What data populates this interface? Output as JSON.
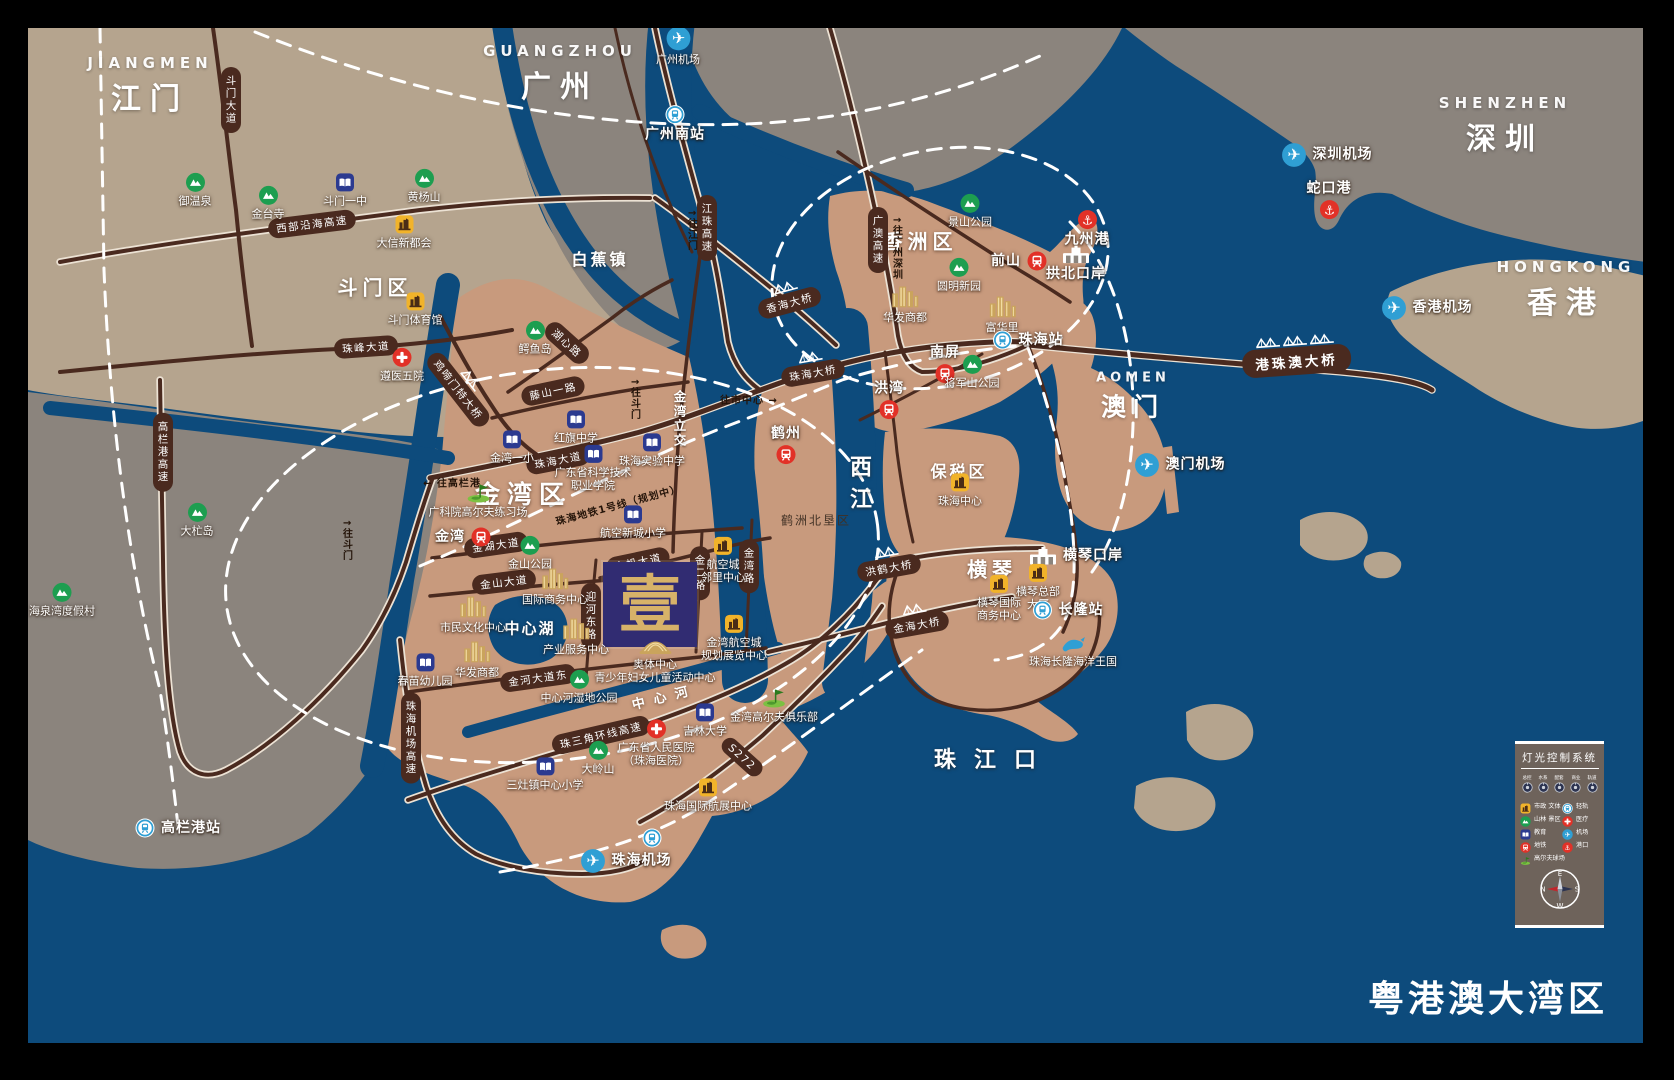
{
  "title": "粤港澳大湾区",
  "colors": {
    "sea": "#0d4b7c",
    "gray": "#8b847d",
    "tan": "#b5a48e",
    "zhuhai": "#c89a7d",
    "road": "#4a2a1f",
    "casing": "#ece2d4",
    "dash": "#ffffff",
    "logo": "#312c72",
    "gold": "#d7b269",
    "legend": "#6e635b",
    "green": "#1d9e50",
    "edu": "#2b3a90",
    "civic": "#f1b32a",
    "red": "#e23127",
    "rail": "#2f9fd4",
    "bld": "#caa45c"
  },
  "logo": {
    "char": "壹"
  },
  "legend": {
    "title": "灯光控制系统",
    "knobs": [
      "总控",
      "水系",
      "配套",
      "商业",
      "轨道"
    ],
    "items": [
      {
        "label": "市政 文体",
        "type": "civic"
      },
      {
        "label": "轻轨",
        "type": "rail"
      },
      {
        "label": "山林 景区",
        "type": "mountain"
      },
      {
        "label": "医疗",
        "type": "hospital"
      },
      {
        "label": "教育",
        "type": "education"
      },
      {
        "label": "机场",
        "type": "airport"
      },
      {
        "label": "地铁",
        "type": "metro"
      },
      {
        "label": "港口",
        "type": "port"
      },
      {
        "label": "高尔夫球场",
        "type": "golf"
      }
    ],
    "compass": {
      "top": "E",
      "left": "N",
      "right": "S",
      "bottom": "W"
    }
  },
  "map": {
    "cities": [
      {
        "en": "JIANGMEN",
        "zh": "江门",
        "x": 150,
        "y": 86
      },
      {
        "en": "GUANGZHOU",
        "zh": "广州",
        "x": 560,
        "y": 74
      },
      {
        "en": "SHENZHEN",
        "zh": "深圳",
        "x": 1505,
        "y": 126
      },
      {
        "en": "HONGKONG",
        "zh": "香港",
        "x": 1566,
        "y": 290
      },
      {
        "en": "AOMEN",
        "zh": "澳门",
        "x": 1133,
        "y": 397,
        "small": true
      }
    ],
    "areas": [
      {
        "l": "斗门区",
        "x": 375,
        "y": 286,
        "fs": 20,
        "ls": 5
      },
      {
        "l": "白蕉镇",
        "x": 600,
        "y": 258,
        "fs": 16,
        "ls": 3
      },
      {
        "l": "香洲区",
        "x": 920,
        "y": 240,
        "fs": 20,
        "ls": 5
      },
      {
        "l": "金湾区",
        "x": 523,
        "y": 493,
        "fs": 25,
        "ls": 7
      },
      {
        "l": "保税区",
        "x": 959,
        "y": 470,
        "fs": 16,
        "ls": 3
      },
      {
        "l": "横琴",
        "x": 992,
        "y": 568,
        "fs": 20,
        "ls": 5
      },
      {
        "l": "鹤洲北垦区",
        "x": 816,
        "y": 520,
        "fs": 12,
        "ls": 2,
        "dark": true
      },
      {
        "l": "中心湖",
        "x": 530,
        "y": 628,
        "fs": 15,
        "ls": 2
      }
    ],
    "water": [
      {
        "l": "西江",
        "x": 858,
        "y": 487,
        "fs": 22,
        "ls": 10,
        "v": true
      },
      {
        "l": "中心河",
        "x": 664,
        "y": 696,
        "fs": 13,
        "ls": 9,
        "rot": -14
      },
      {
        "l": "珠江口",
        "x": 994,
        "y": 758,
        "fs": 22,
        "ls": 18
      }
    ],
    "nav": [
      {
        "l": "往市中心 →",
        "x": 749,
        "y": 399
      },
      {
        "l": "← 往高栏港",
        "x": 452,
        "y": 482
      },
      {
        "l": "↑往斗门",
        "x": 634,
        "y": 399,
        "v": true
      },
      {
        "l": "↑往斗门",
        "x": 346,
        "y": 540,
        "v": true
      },
      {
        "l": "↑往江门",
        "x": 691,
        "y": 230,
        "v": true
      },
      {
        "l": "↑往广州深圳",
        "x": 896,
        "y": 248,
        "v": true
      },
      {
        "l": "金湾立交",
        "x": 679,
        "y": 419,
        "v": true,
        "w": true
      },
      {
        "l": "珠海地铁1号线（规划中）",
        "x": 618,
        "y": 504,
        "rot": -15
      }
    ],
    "road_badges": [
      {
        "l": "斗门大道",
        "x": 231,
        "y": 100,
        "v": true
      },
      {
        "l": "西部沿海高速",
        "x": 312,
        "y": 224,
        "r": -7
      },
      {
        "l": "江珠高速",
        "x": 707,
        "y": 228,
        "v": true
      },
      {
        "l": "广澳高速",
        "x": 878,
        "y": 240,
        "v": true
      },
      {
        "l": "珠峰大道",
        "x": 366,
        "y": 347,
        "r": -4
      },
      {
        "l": "湖心路",
        "x": 567,
        "y": 343,
        "r": 42
      },
      {
        "l": "藤山一路",
        "x": 553,
        "y": 391,
        "r": -12
      },
      {
        "l": "珠海大道",
        "x": 558,
        "y": 460,
        "r": -11
      },
      {
        "l": "金湖大道",
        "x": 496,
        "y": 545,
        "r": -8
      },
      {
        "l": "金山大道",
        "x": 504,
        "y": 582,
        "r": -7
      },
      {
        "l": "金河大道东",
        "x": 538,
        "y": 678,
        "r": -8
      },
      {
        "l": "金帆大道",
        "x": 638,
        "y": 562,
        "r": -12
      },
      {
        "l": "迎河东路",
        "x": 591,
        "y": 616,
        "v": true
      },
      {
        "l": "金二路",
        "x": 700,
        "y": 573,
        "v": true
      },
      {
        "l": "金湾路",
        "x": 749,
        "y": 566,
        "v": true
      },
      {
        "l": "珠三角环线高速",
        "x": 601,
        "y": 735,
        "r": -13
      },
      {
        "l": "S272",
        "x": 742,
        "y": 757,
        "r": 42
      },
      {
        "l": "珠海机场高速",
        "x": 411,
        "y": 738,
        "v": true
      },
      {
        "l": "高栏港高速",
        "x": 163,
        "y": 452,
        "v": true
      }
    ],
    "bridges": [
      {
        "l": "鸡啼门特大桥",
        "x": 463,
        "y": 386,
        "r": 52
      },
      {
        "l": "香海大桥",
        "x": 788,
        "y": 297,
        "r": -15
      },
      {
        "l": "珠海大桥",
        "x": 812,
        "y": 367,
        "r": -10
      },
      {
        "l": "洪鹤大桥",
        "x": 888,
        "y": 562,
        "r": -10
      },
      {
        "l": "金海大桥",
        "x": 916,
        "y": 619,
        "r": -10
      },
      {
        "l": "港珠澳大桥",
        "x": 1296,
        "y": 355,
        "r": -4,
        "big": true,
        "n": 3
      }
    ],
    "markers": [
      {
        "t": "mountain",
        "x": 195,
        "y": 190,
        "l": "御温泉"
      },
      {
        "t": "mountain",
        "x": 268,
        "y": 203,
        "l": "金台寺"
      },
      {
        "t": "education",
        "x": 345,
        "y": 190,
        "l": "斗门一中"
      },
      {
        "t": "mountain",
        "x": 424,
        "y": 186,
        "l": "黄杨山"
      },
      {
        "t": "civic",
        "x": 404,
        "y": 232,
        "l": "大信新都会"
      },
      {
        "t": "civic",
        "x": 415,
        "y": 309,
        "l": "斗门体育馆"
      },
      {
        "t": "hospital",
        "x": 402,
        "y": 365,
        "l": "遵医五院"
      },
      {
        "t": "mountain",
        "x": 535,
        "y": 338,
        "l": "鳄鱼岛"
      },
      {
        "t": "mountain",
        "x": 62,
        "y": 600,
        "l": "海泉湾度假村"
      },
      {
        "t": "mountain",
        "x": 197,
        "y": 520,
        "l": "大杧岛"
      },
      {
        "t": "education",
        "x": 576,
        "y": 427,
        "l": "红旗中学"
      },
      {
        "t": "education",
        "x": 512,
        "y": 447,
        "l": "金湾一小"
      },
      {
        "t": "education",
        "x": 652,
        "y": 450,
        "l": "珠海实验中学"
      },
      {
        "t": "education",
        "x": 593,
        "y": 468,
        "l": "广东省科学技术\n职业学院"
      },
      {
        "t": "education",
        "x": 633,
        "y": 522,
        "l": "航空新城小学"
      },
      {
        "t": "golf",
        "x": 478,
        "y": 500,
        "l": "广科院高尔夫练习场"
      },
      {
        "t": "metro",
        "x": 463,
        "y": 537,
        "l": "金湾",
        "lp": "l",
        "big": true
      },
      {
        "t": "mountain",
        "x": 530,
        "y": 553,
        "l": "金山公园"
      },
      {
        "t": "goldbld",
        "x": 555,
        "y": 585,
        "l": "国际商务中心"
      },
      {
        "t": "goldbld",
        "x": 473,
        "y": 613,
        "l": "市民文化中心"
      },
      {
        "t": "goldbld",
        "x": 576,
        "y": 635,
        "l": "产业服务中心"
      },
      {
        "t": "goldbld",
        "x": 477,
        "y": 658,
        "l": "华发商都"
      },
      {
        "t": "education",
        "x": 425,
        "y": 670,
        "l": "春苗幼儿园"
      },
      {
        "t": "stadium",
        "x": 655,
        "y": 660,
        "l": "奥体中心\n青少年妇女儿童活动中心"
      },
      {
        "t": "civic",
        "x": 723,
        "y": 560,
        "l": "航空城\n邻里中心"
      },
      {
        "t": "civic",
        "x": 734,
        "y": 638,
        "l": "金湾航空城\n规划展览中心"
      },
      {
        "t": "mountain",
        "x": 579,
        "y": 687,
        "l": "中心河湿地公园"
      },
      {
        "t": "education",
        "x": 705,
        "y": 720,
        "l": "吉林大学"
      },
      {
        "t": "hospital",
        "x": 656,
        "y": 743,
        "l": "广东省人民医院\n（珠海医院）"
      },
      {
        "t": "mountain",
        "x": 598,
        "y": 758,
        "l": "大岭山"
      },
      {
        "t": "education",
        "x": 545,
        "y": 774,
        "l": "三灶镇中心小学"
      },
      {
        "t": "golf",
        "x": 774,
        "y": 705,
        "l": "金湾高尔夫俱乐部"
      },
      {
        "t": "civic",
        "x": 708,
        "y": 795,
        "l": "珠海国际航展中心"
      },
      {
        "t": "rail",
        "x": 652,
        "y": 838,
        "l": ""
      },
      {
        "t": "airport",
        "x": 626,
        "y": 861,
        "l": "珠海机场",
        "lp": "r",
        "big": true
      },
      {
        "t": "airport",
        "x": 678,
        "y": 46,
        "l": "广州机场"
      },
      {
        "t": "rail",
        "x": 675,
        "y": 124,
        "l": "广州南站",
        "big": true
      },
      {
        "t": "mountain",
        "x": 970,
        "y": 211,
        "l": "景山公园"
      },
      {
        "t": "metro",
        "x": 1019,
        "y": 261,
        "l": "前山",
        "lp": "l",
        "big": true
      },
      {
        "t": "mountain",
        "x": 959,
        "y": 275,
        "l": "圆明新园"
      },
      {
        "t": "goldbld",
        "x": 905,
        "y": 303,
        "l": "华发商都"
      },
      {
        "t": "goldbld",
        "x": 1002,
        "y": 313,
        "l": "富华里"
      },
      {
        "t": "metro",
        "x": 945,
        "y": 364,
        "l": "南屏",
        "lp": "a",
        "big": true
      },
      {
        "t": "metro",
        "x": 889,
        "y": 400,
        "l": "洪湾",
        "lp": "a",
        "big": true
      },
      {
        "t": "metro",
        "x": 786,
        "y": 445,
        "l": "鹤州",
        "lp": "a",
        "big": true
      },
      {
        "t": "mountain",
        "x": 972,
        "y": 372,
        "l": "将军山公园"
      },
      {
        "t": "civic",
        "x": 960,
        "y": 490,
        "l": "珠海中心"
      },
      {
        "t": "port",
        "x": 1087,
        "y": 229,
        "l": "九州港",
        "big": true
      },
      {
        "t": "customs",
        "x": 1076,
        "y": 264,
        "l": "拱北口岸",
        "big": true
      },
      {
        "t": "rail",
        "x": 1028,
        "y": 340,
        "l": "珠海站",
        "lp": "r",
        "big": true
      },
      {
        "t": "customs",
        "x": 1076,
        "y": 556,
        "l": "横琴口岸",
        "lp": "r",
        "big": true
      },
      {
        "t": "civic",
        "x": 999,
        "y": 598,
        "l": "横琴国际\n商务中心"
      },
      {
        "t": "civic",
        "x": 1038,
        "y": 587,
        "l": "横琴总部\n大厦"
      },
      {
        "t": "rail",
        "x": 1068,
        "y": 610,
        "l": "长隆站",
        "lp": "r",
        "big": true
      },
      {
        "t": "whale",
        "x": 1073,
        "y": 652,
        "l": "珠海长隆海洋王国"
      },
      {
        "t": "rail",
        "x": 178,
        "y": 828,
        "l": "高栏港站",
        "lp": "r",
        "big": true
      },
      {
        "t": "airport",
        "x": 1327,
        "y": 155,
        "l": "深圳机场",
        "lp": "r",
        "big": true
      },
      {
        "t": "port",
        "x": 1329,
        "y": 200,
        "l": "蛇口港",
        "lp": "a",
        "big": true
      },
      {
        "t": "airport",
        "x": 1427,
        "y": 308,
        "l": "香港机场",
        "lp": "r",
        "big": true
      },
      {
        "t": "airport",
        "x": 1180,
        "y": 465,
        "l": "澳门机场",
        "lp": "r",
        "big": true
      }
    ]
  }
}
